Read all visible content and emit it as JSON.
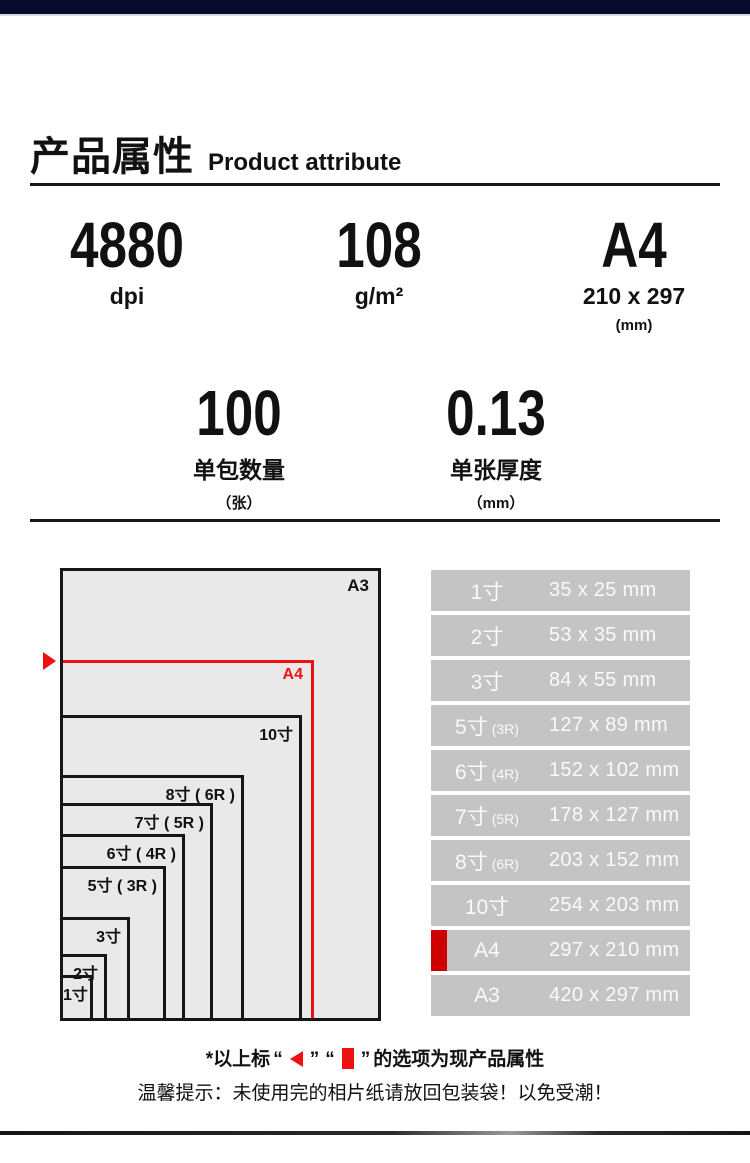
{
  "colors": {
    "top_bar": "#060a2b",
    "accent_red": "#ee1111",
    "marker_red": "#cf0000",
    "table_row_bg": "#c4c4c4",
    "table_text": "#fafafa",
    "diagram_bg": "#e9e9e9",
    "ink": "#111111"
  },
  "header": {
    "title_cn": "产品属性",
    "title_en": "Product attribute"
  },
  "specs": [
    {
      "value": "4880",
      "unit": "dpi",
      "sub": ""
    },
    {
      "value": "108",
      "unit": "g/m²",
      "sub": ""
    },
    {
      "value": "A4",
      "unit": "210 x 297",
      "sub": "(mm)"
    },
    {
      "value": "100",
      "unit": "单包数量",
      "sub": "（张）"
    },
    {
      "value": "0.13",
      "unit": "单张厚度",
      "sub": "（mm）"
    }
  ],
  "diagram": {
    "outer_label": "A3",
    "boxes": [
      {
        "label": "A4",
        "w": 251,
        "h": 358,
        "accent": true
      },
      {
        "label": "10寸",
        "w": 239,
        "h": 303
      },
      {
        "label": "8寸 ( 6R )",
        "w": 181,
        "h": 243
      },
      {
        "label": "7寸 ( 5R )",
        "w": 150,
        "h": 215
      },
      {
        "label": "6寸 ( 4R )",
        "w": 122,
        "h": 184
      },
      {
        "label": "5寸 ( 3R )",
        "w": 103,
        "h": 152
      },
      {
        "label": "3寸",
        "w": 67,
        "h": 101
      },
      {
        "label": "2寸",
        "w": 44,
        "h": 64
      },
      {
        "label": "1寸",
        "w": 30,
        "h": 43
      }
    ]
  },
  "table": {
    "rows": [
      {
        "label": "1寸",
        "suffix": "",
        "value": "35 x 25 mm",
        "marked": false
      },
      {
        "label": "2寸",
        "suffix": "",
        "value": "53 x 35 mm",
        "marked": false
      },
      {
        "label": "3寸",
        "suffix": "",
        "value": "84 x 55 mm",
        "marked": false
      },
      {
        "label": "5寸",
        "suffix": "(3R)",
        "value": "127 x 89 mm",
        "marked": false
      },
      {
        "label": "6寸",
        "suffix": "(4R)",
        "value": "152 x 102 mm",
        "marked": false
      },
      {
        "label": "7寸",
        "suffix": "(5R)",
        "value": "178 x 127 mm",
        "marked": false
      },
      {
        "label": "8寸",
        "suffix": "(6R)",
        "value": "203 x 152 mm",
        "marked": false
      },
      {
        "label": "10寸",
        "suffix": "",
        "value": "254 x 203 mm",
        "marked": false
      },
      {
        "label": "A4",
        "suffix": "",
        "value": "297 x 210 mm",
        "marked": true
      },
      {
        "label": "A3",
        "suffix": "",
        "value": "420 x 297 mm",
        "marked": false
      }
    ]
  },
  "footer": {
    "note_prefix": "*以上标",
    "quote_open": "“",
    "quote_close": "”",
    "note_suffix": "的选项为现产品属性",
    "tip": "温馨提示：未使用完的相片纸请放回包装袋！以免受潮！"
  }
}
